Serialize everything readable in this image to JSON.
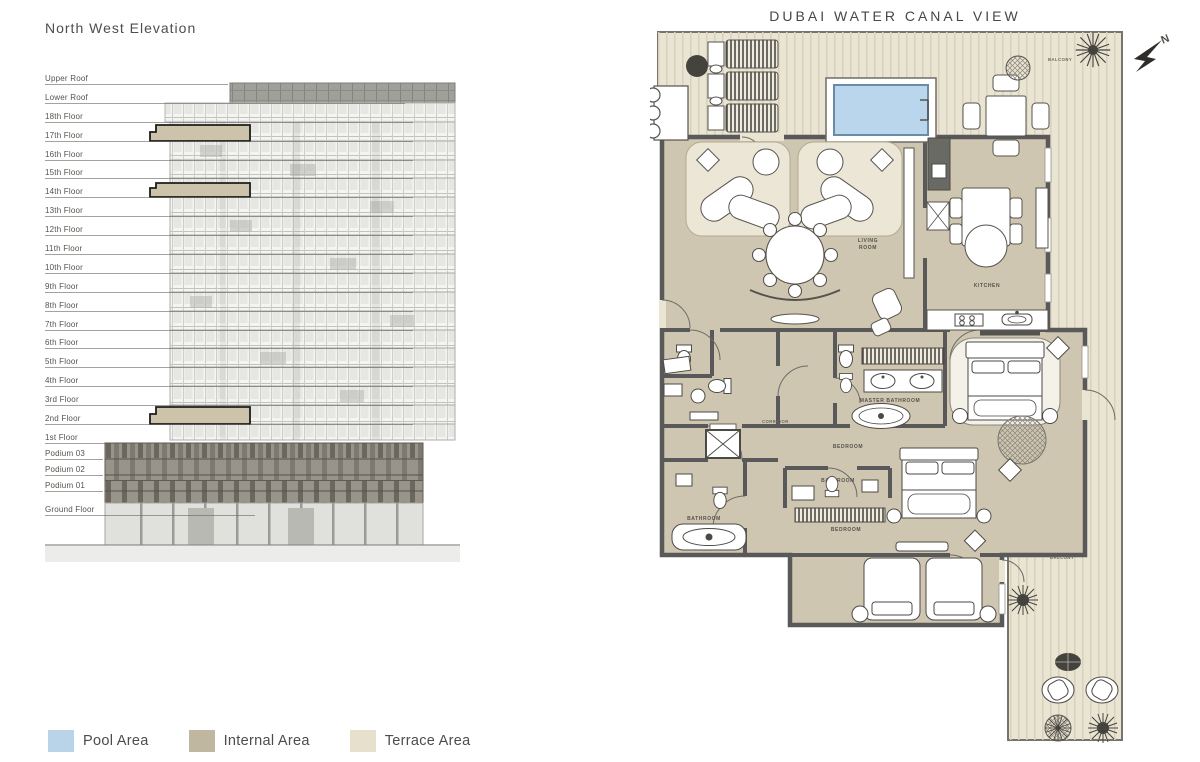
{
  "elevation": {
    "title": "North West Elevation",
    "floors": [
      "Upper Roof",
      "Lower Roof",
      "18th Floor",
      "17th Floor",
      "16th Floor",
      "15th Floor",
      "14th Floor",
      "13th Floor",
      "12th Floor",
      "11th Floor",
      "10th Floor",
      "9th Floor",
      "8th Floor",
      "7th Floor",
      "6th Floor",
      "5th Floor",
      "4th Floor",
      "3rd Floor",
      "2nd Floor",
      "1st Floor",
      "Podium 03",
      "Podium 02",
      "Podium 01",
      "Ground Floor"
    ],
    "highlighted_floors": [
      "17th Floor",
      "14th Floor",
      "2nd Floor"
    ],
    "highlight_color": "#cdc3aa"
  },
  "legend": {
    "items": [
      {
        "label": "Pool Area",
        "color": "#b9d3e8"
      },
      {
        "label": "Internal Area",
        "color": "#c0b7a1"
      },
      {
        "label": "Terrace Area",
        "color": "#e7e0cc"
      }
    ]
  },
  "floorplan": {
    "title": "DUBAI WATER CANAL VIEW",
    "north_label": "N",
    "labels": {
      "balcony_top": "BALCONY",
      "balcony_bottom": "BALCONY",
      "living_room_line1": "LIVING",
      "living_room_line2": "ROOM",
      "kitchen": "KITCHEN",
      "master_bathroom": "MASTER BATHROOM",
      "bedroom_middle": "BEDROOM",
      "bedroom_bottom": "BEDROOM",
      "bathroom_middle": "BATHROOM",
      "bathroom_bottom_left": "BATHROOM",
      "corridor": "CORRIDOR"
    },
    "colors": {
      "pool": "#b9d6ec",
      "internal": "#cfc6b2",
      "terrace": "#eae4d3",
      "wall": "#595959"
    }
  }
}
